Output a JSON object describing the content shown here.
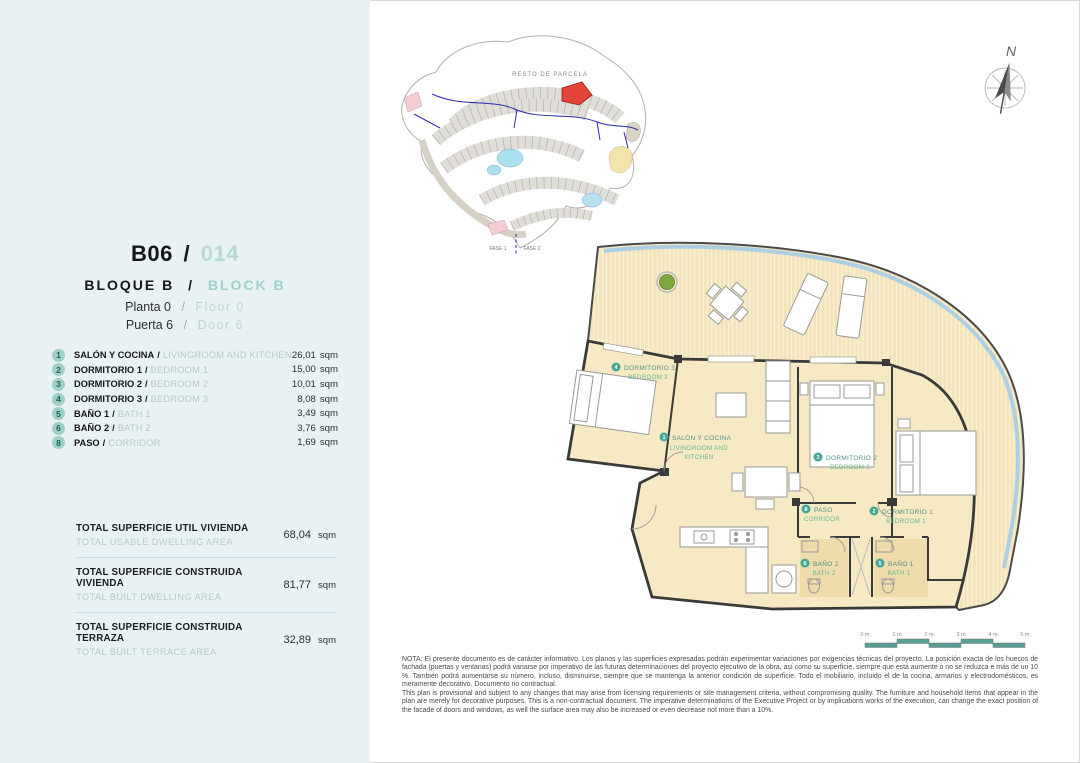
{
  "sep": "/",
  "header": {
    "unit_code": "B06",
    "unit_number": "014",
    "block_es": "BLOQUE B",
    "block_en": "BLOCK B",
    "floor_es": "Planta 0",
    "floor_en": "Floor 0",
    "door_es": "Puerta 6",
    "door_en": "Door 6"
  },
  "rooms": [
    {
      "num": "1",
      "name_es": "SALÓN Y COCINA",
      "name_en": "LIVINGROOM AND KITCHEN",
      "area": "26,01",
      "unit": "sqm"
    },
    {
      "num": "2",
      "name_es": "DORMITORIO 1",
      "name_en": "BEDROOM 1",
      "area": "15,00",
      "unit": "sqm"
    },
    {
      "num": "3",
      "name_es": "DORMITORIO 2",
      "name_en": "BEDROOM 2",
      "area": "10,01",
      "unit": "sqm"
    },
    {
      "num": "4",
      "name_es": "DORMITORIO 3",
      "name_en": "BEDROOM 3",
      "area": "8,08",
      "unit": "sqm"
    },
    {
      "num": "5",
      "name_es": "BAÑO 1",
      "name_en": "BATH 1",
      "area": "3,49",
      "unit": "sqm"
    },
    {
      "num": "6",
      "name_es": "BAÑO 2",
      "name_en": "BATH 2",
      "area": "3,76",
      "unit": "sqm"
    },
    {
      "num": "8",
      "name_es": "PASO",
      "name_en": "CORRIDOR",
      "area": "1,69",
      "unit": "sqm"
    }
  ],
  "totals": [
    {
      "label_es": "TOTAL SUPERFICIE UTIL VIVIENDA",
      "label_en": "TOTAL USABLE DWELLING AREA",
      "value": "68,04",
      "unit": "sqm"
    },
    {
      "label_es": "TOTAL SUPERFICIE CONSTRUIDA VIVIENDA",
      "label_en": "TOTAL BUILT DWELLING AREA",
      "value": "81,77",
      "unit": "sqm"
    },
    {
      "label_es": "TOTAL SUPERFICIE CONSTRUIDA TERRAZA",
      "label_en": "TOTAL BUILT TERRACE AREA",
      "value": "32,89",
      "unit": "sqm"
    }
  ],
  "site_plan": {
    "parcel_label": "RESTO DE PARCELA",
    "phase_1": "FASE 1",
    "phase_2": "FASE 2"
  },
  "compass": {
    "north_label": "N"
  },
  "floor_plan": {
    "labels": [
      {
        "num": "1",
        "es": "SALÓN Y COCINA",
        "en1": "LIVINGROOM AND",
        "en2": "KITCHEN"
      },
      {
        "num": "2",
        "es": "DORMITORIO 1",
        "en1": "BEDROOM 1"
      },
      {
        "num": "3",
        "es": "DORMITORIO 2",
        "en1": "BEDROOM 2"
      },
      {
        "num": "4",
        "es": "DORMITORIO 3",
        "en1": "BEDROOM 3"
      },
      {
        "num": "5",
        "es": "BAÑO 1",
        "en1": "BATH 1"
      },
      {
        "num": "6",
        "es": "BAÑO 2",
        "en1": "BATH 2"
      },
      {
        "num": "8",
        "es": "PASO",
        "en1": "CORRIDOR"
      }
    ]
  },
  "scale_bar": {
    "labels": [
      "0 m",
      "1 m",
      "2 m",
      "3 m",
      "4 m",
      "5 m"
    ]
  },
  "note": {
    "es": "NOTA: El presente documento es de carácter informativo. Los planos y las superficies expresadas podrán experimentar variaciones por exigencias técnicas del proyecto. La posición exacta de los huecos de fachada (puertas y ventanas) podrá variarse por imperativo de las futuras determinaciones del proyecto ejecutivo de la obra, así como su superficie, siempre que está aumente o no se reduzca e más de un 10 %. También podrá aumentarse su número, incluso, disminuirse, siempre que se mantenga la anterior condición de superficie. Todo el mobiliario, incluido el de la cocina, armarios y electrodomésticos, es meramente decorativo. Documento no contractual.",
    "en": "This plan is provisional and subject to any changes that may arise from licensing requirements or site management criteria, without compromising quality. The furniture and household items that appear in the plan are merely for decorative purposes. This is a non-contractual document. The imperative determinations of the Executive Project or by implications works of the execution, can change the exact position of the facade of doors and windows, as well the surface area may also be increased or even decrease not more than a 10%."
  },
  "colors": {
    "sidebar_bg": "#e8f2f5",
    "accent_teal": "#9fd0ca",
    "badge_teal": "#9fd0c8",
    "plan_label_es": "#56908a",
    "plan_label_en": "#63b893",
    "room_fill": "#f7e9c4",
    "balustrade_blue": "#a5cce6",
    "highlight_red": "#e4453a"
  }
}
